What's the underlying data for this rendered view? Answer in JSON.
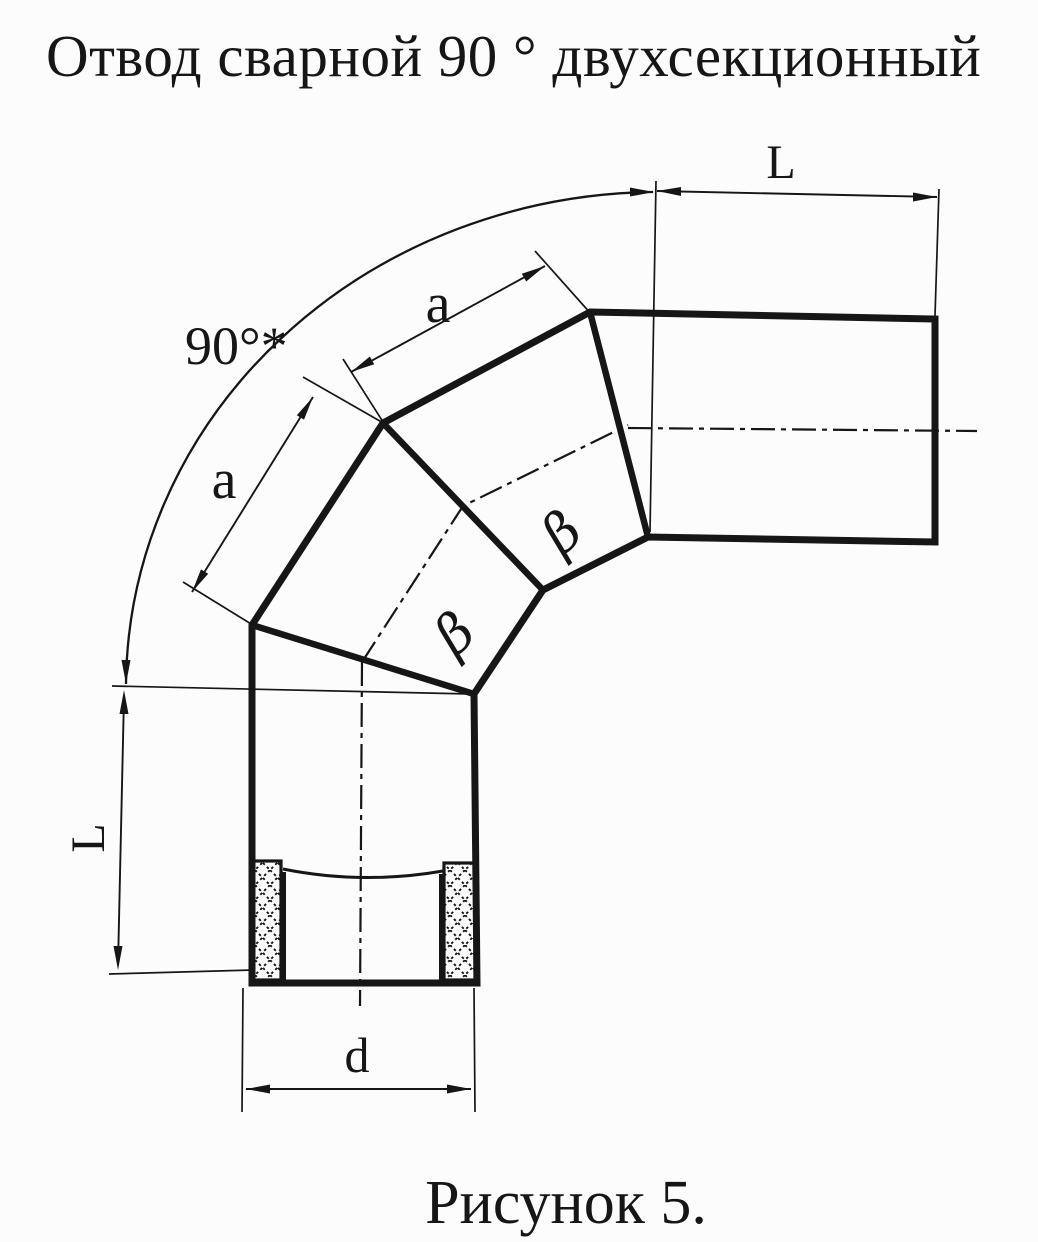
{
  "title": "Отвод сварной 90 ° двухсекционный",
  "caption": "Рисунок 5.",
  "drawing": {
    "angle_label": "90°*",
    "top_length_label": "L",
    "left_length_label": "L",
    "upper_section_length_label": "a",
    "lower_section_length_label": "a",
    "diameter_label": "d",
    "upper_bevel_angle_label": "β",
    "lower_bevel_angle_label": "β"
  },
  "colors": {
    "ink": "#161616",
    "paper": "#fcfcfc"
  }
}
